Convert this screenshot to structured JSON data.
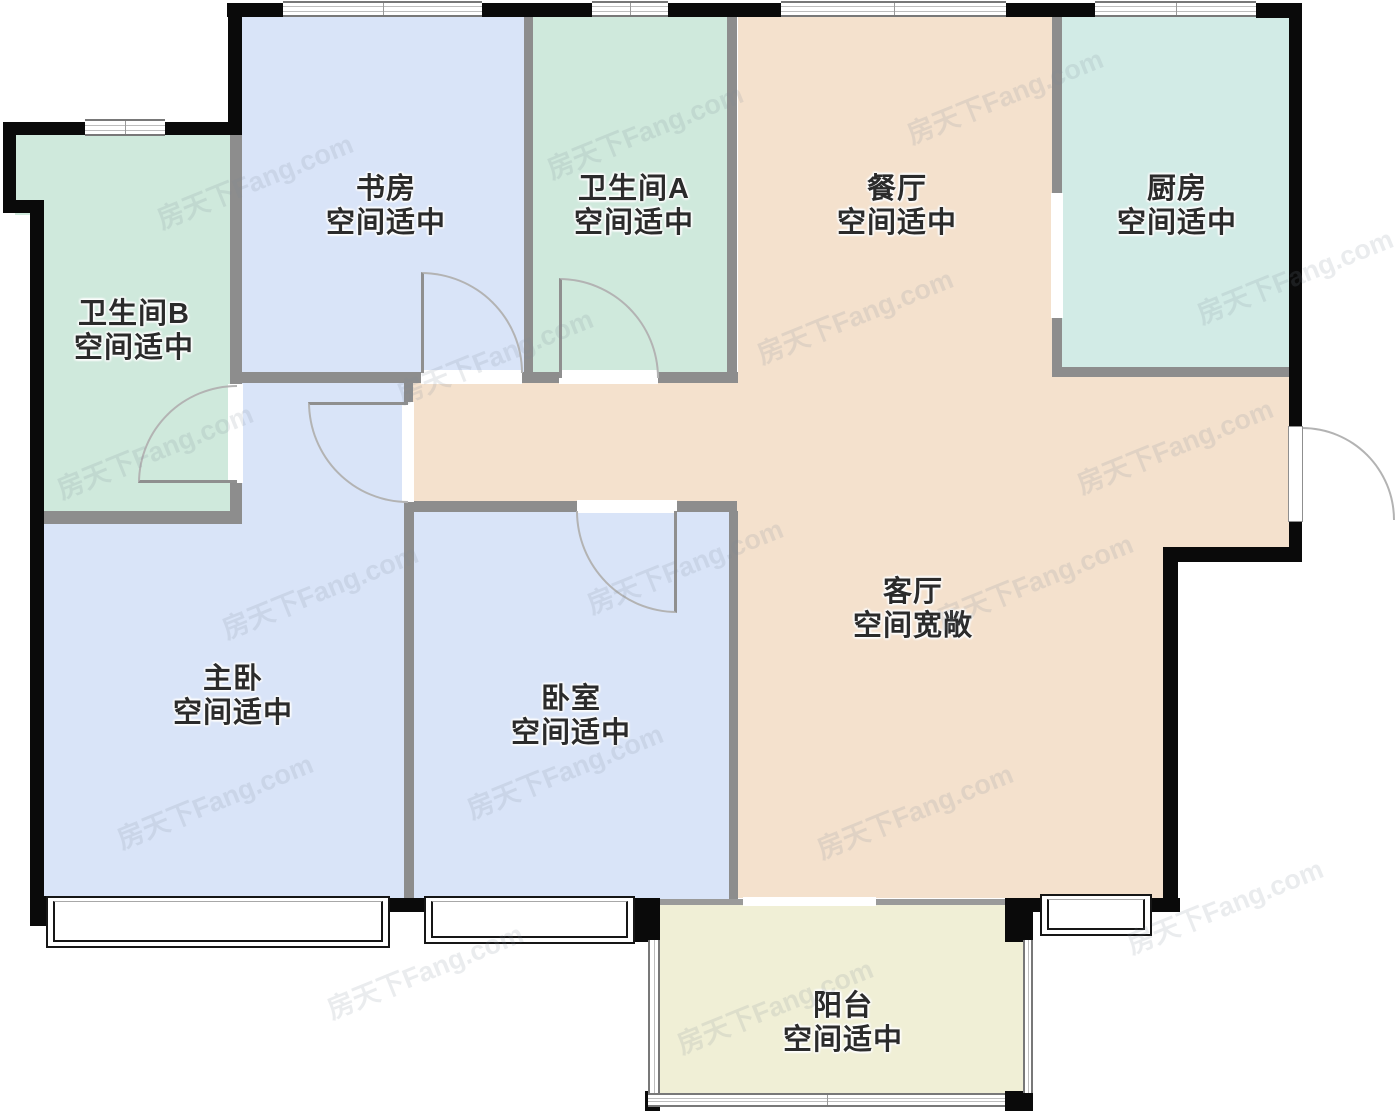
{
  "watermark": {
    "text": "房天下Fang.com"
  },
  "palette": {
    "wall_exterior": "#0a0a0a",
    "wall_interior": "#8d8d8d",
    "bedroom_fill": "#d9e4f8",
    "bath_fill": "#cfe9dc",
    "kitchen_fill": "#d2ebe6",
    "living_fill": "#f4e1cd",
    "balcony_fill": "#f0efd6"
  },
  "rooms": [
    {
      "id": "study",
      "name": "书房",
      "note": "空间适中"
    },
    {
      "id": "bathroom-a",
      "name": "卫生间A",
      "note": "空间适中"
    },
    {
      "id": "dining-room",
      "name": "餐厅",
      "note": "空间适中"
    },
    {
      "id": "kitchen",
      "name": "厨房",
      "note": "空间适中"
    },
    {
      "id": "bathroom-b",
      "name": "卫生间B",
      "note": "空间适中"
    },
    {
      "id": "master-bedroom",
      "name": "主卧",
      "note": "空间适中"
    },
    {
      "id": "bedroom",
      "name": "卧室",
      "note": "空间适中"
    },
    {
      "id": "living-room",
      "name": "客厅",
      "note": "空间宽敞"
    },
    {
      "id": "balcony",
      "name": "阳台",
      "note": "空间适中"
    }
  ]
}
